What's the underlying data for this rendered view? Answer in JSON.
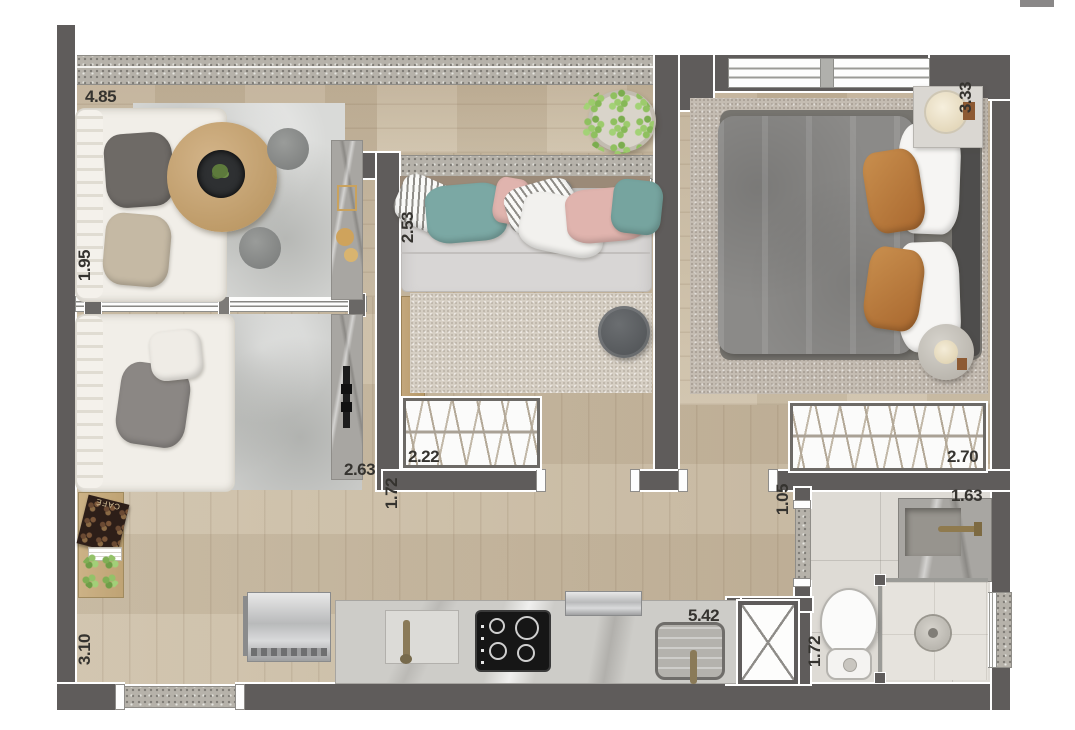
{
  "plan": {
    "type": "apartment-floor-plan",
    "labels": {
      "balcony_width": "4.85",
      "balcony_depth": "1.95",
      "bedroom2_depth": "2.53",
      "bedroom1_depth": "3.33",
      "living_width": "2.63",
      "wardrobe2_width": "2.22",
      "hall_width": "1.72",
      "wardrobe1_width": "2.70",
      "bath_door": "1.05",
      "bath_width": "1.63",
      "kitchen_length": "5.42",
      "bath_depth": "1.72",
      "living_depth": "3.10"
    },
    "decor_text": {
      "cafe_board": "CAFÉ"
    },
    "colors": {
      "wall": "#5f5c5b",
      "wall_outline": "#ffffff",
      "wood_floor": "#c9bba4",
      "granite": "#b6b2aa",
      "silver_rug": "#d9dad8",
      "bedroom_carpet": "#c4bcb2",
      "bath_tile": "#dedbd5",
      "duvet_gray": "#8b8a88",
      "pillow_teal": "#7ba8a4",
      "pillow_pink": "#e0b4ae",
      "pillow_caramel": "#b5793f",
      "table_wood": "#c8a87c",
      "cooktop_black": "#161616"
    }
  }
}
